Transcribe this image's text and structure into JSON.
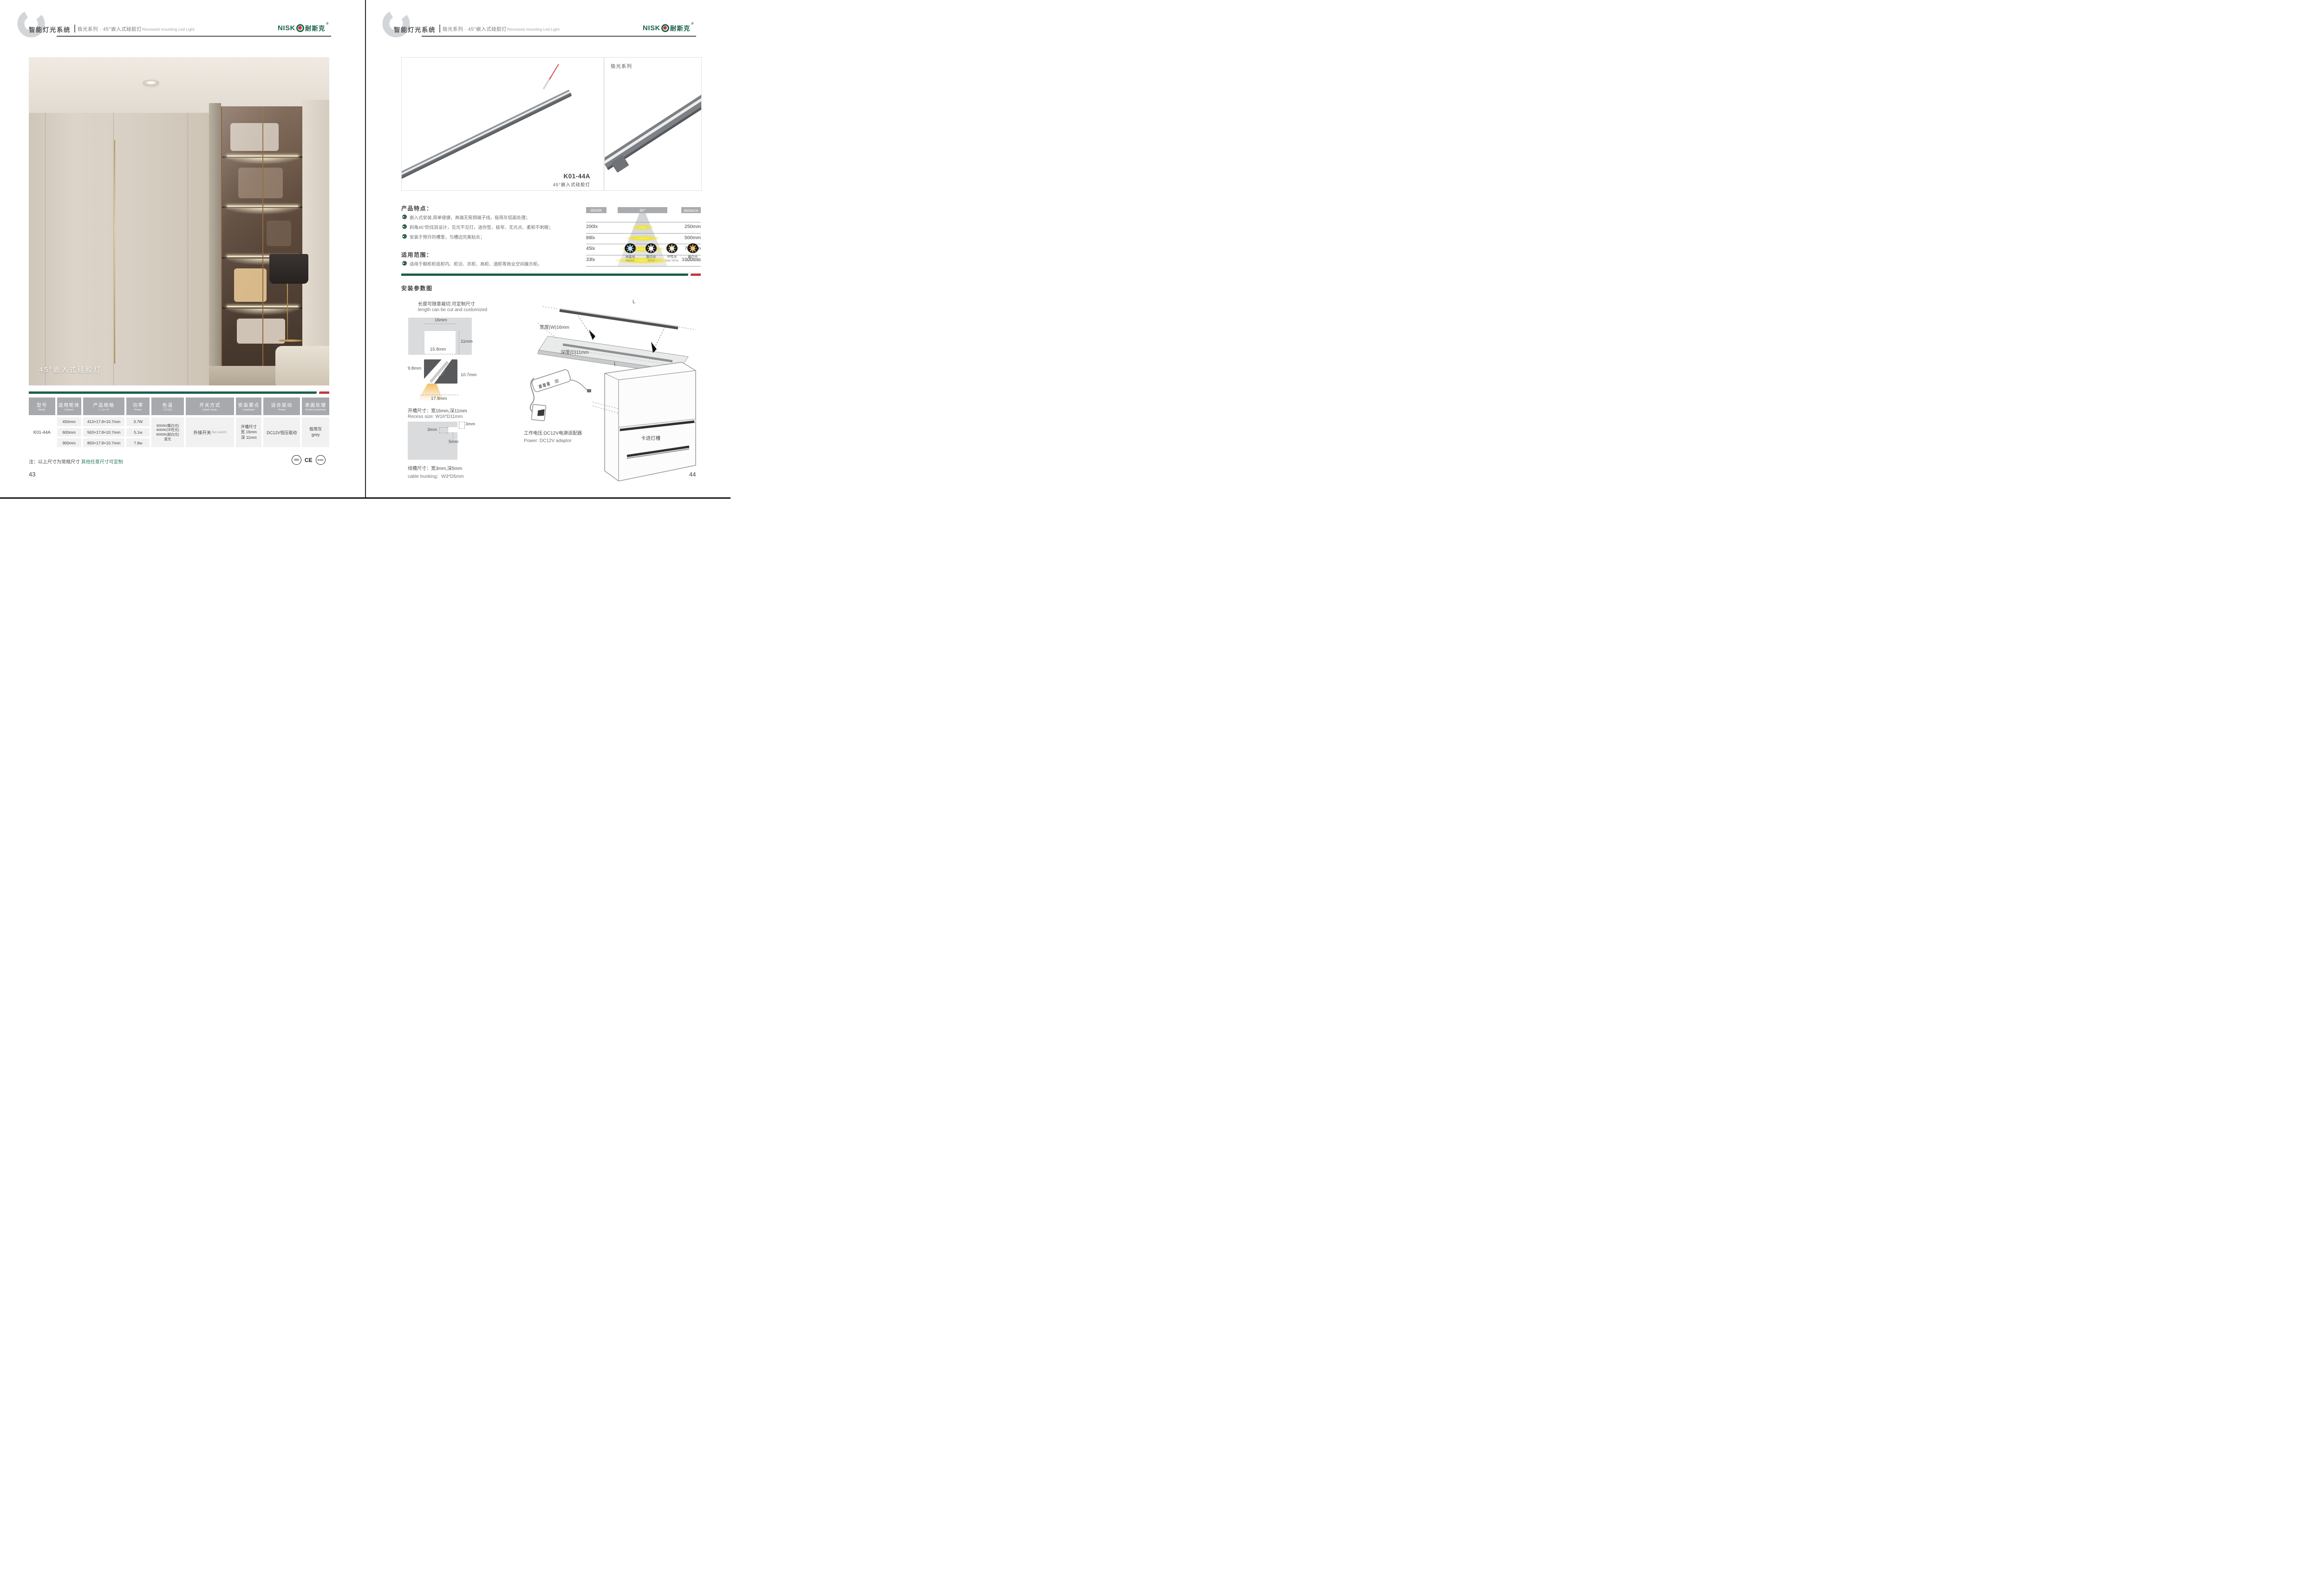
{
  "colors": {
    "brand_green": "#1b6146",
    "accent_red": "#c03a40",
    "table_header_gray": "#a7a9ac"
  },
  "header": {
    "system_title": "智能灯光系统",
    "series_title": "极光系列 · 45°嵌入式硅胶灯",
    "series_subtitle_en": "Recessed mounting Led Light",
    "logo_head": "NISK",
    "logo_cjk": "耐斯克",
    "logo_reg": "®"
  },
  "left_page": {
    "photo_caption": "45°嵌入式硅胶灯",
    "table": {
      "columns": [
        {
          "cn": "型号",
          "en": "Model"
        },
        {
          "cn": "适用柜体",
          "en": "Cabinet"
        },
        {
          "cn": "产品规格",
          "en": "L x D x H"
        },
        {
          "cn": "功率",
          "en": "Power"
        },
        {
          "cn": "色温",
          "en": "CCT(K)"
        },
        {
          "cn": "开关方式",
          "en": "Switch mode"
        },
        {
          "cn": "安装要点",
          "en": "Installation"
        },
        {
          "cn": "适合驱动",
          "en": "Power"
        },
        {
          "cn": "表面处理",
          "en": "Surface treatment"
        }
      ],
      "model": "K01-44A",
      "rows": [
        {
          "cabinet": "450mm",
          "spec": "413×17.8×10.7mm",
          "power": "3.7W"
        },
        {
          "cabinet": "600mm",
          "spec": "563×17.8×10.7mm",
          "power": "5.1w"
        },
        {
          "cabinet": "900mm",
          "spec": "863×17.8×10.7mm",
          "power": "7.8w"
        }
      ],
      "cct": "3000K(暖白光)\n4000K(中性光)\n6000K(超白光)\n蓝光",
      "switch_cn": "外接开关",
      "switch_en": "/No switch",
      "installation": "开槽尺寸\n宽 16mm\n深 11mm",
      "driver": "DC12V恒压驱动",
      "surface": "极简灰\ngrey"
    },
    "note_prefix": "注：以上尺寸为常规尺寸 ",
    "note_highlight": "其他任意尺寸可定制",
    "certs": [
      "CCC",
      "CE",
      "RoHS"
    ],
    "page_number": "43"
  },
  "right_page": {
    "product": {
      "model": "K01-44A",
      "name": "45°嵌入式硅胶灯",
      "series_label": "极光系列"
    },
    "features": {
      "title": "产品特点：",
      "items": [
        "嵌入式安装,简单便捷，高端无氧铜端子线，极简灰铝面处理；",
        "斜角45°防炫目设计，见光不见灯，迷你型、极窄、无光点、柔和不刺眼；",
        "安装于预开的槽里，与槽边完美贴合；"
      ]
    },
    "application": {
      "title": "适用范围：",
      "items": [
        "适用于橱柜柜底柜内、柜沿、衣柜、高柜、酒柜等商业空间展示柜。"
      ]
    },
    "distribution": {
      "cct": "6500K",
      "angle": "90°",
      "distance_label": "distance",
      "rows": [
        {
          "lux": "200lx",
          "dist": "250mm"
        },
        {
          "lux": "88lx",
          "dist": "500mm"
        },
        {
          "lux": "45lx",
          "dist": "750mm"
        },
        {
          "lux": "33lx",
          "dist": "1000mm"
        }
      ]
    },
    "cct_swatches": [
      {
        "cn": "冰蓝光",
        "en": "Basket",
        "color": "#b8e4f5"
      },
      {
        "cn": "超白光",
        "en": "White",
        "color": "#ffffff"
      },
      {
        "cn": "中性光",
        "en": "Cool White",
        "color": "#f6ecd2"
      },
      {
        "cn": "暖白光",
        "en": "Warm White",
        "color": "#f0c274"
      }
    ],
    "install": {
      "title": "安装参数图",
      "cut_note_cn": "长度可随意裁切,可定制尺寸",
      "cut_note_en": "length can be cut and customized",
      "dims": {
        "top": "16mm",
        "depth": "11mm",
        "inner": "15.8mm",
        "left": "9.8mm",
        "right": "10.7mm",
        "bottom": "17.8mm"
      },
      "recess_cn": "开槽尺寸：宽16mm,深11mm",
      "recess_en": "Recess size: W16*D11mm",
      "trunk": {
        "w_top": "3mm",
        "w_side": "3mm",
        "depth": "5mm"
      },
      "trunk_cn": "线槽尺寸：宽3mm,深5mm",
      "trunk_en": "cable trunking：W3*D5mm",
      "board": {
        "length_top": "L",
        "length_in": "L",
        "width_label": "宽度(W)16mm",
        "depth_label": "深度(D)11mm",
        "caption": "建议开槽尺寸"
      },
      "power_cn": "工作电压:DC12V电源适配器",
      "power_en": "Power: DC12V adaptor",
      "clip_label": "卡进灯槽"
    },
    "page_number": "44"
  }
}
